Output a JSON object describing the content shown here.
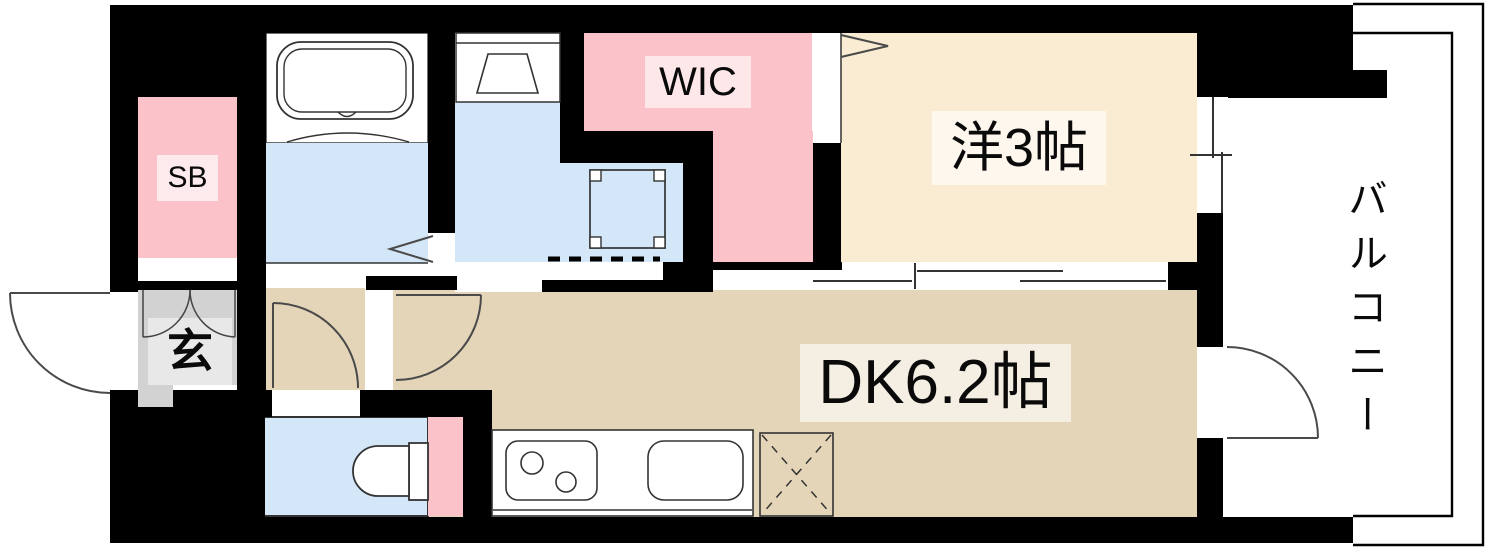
{
  "floorplan": {
    "title": "apartment-floor-plan",
    "rooms": {
      "sb": {
        "label": "SB"
      },
      "entrance": {
        "label": "玄"
      },
      "wic": {
        "label": "WIC"
      },
      "western": {
        "label": "洋3帖"
      },
      "dk": {
        "label": "DK6.2帖"
      },
      "balcony": {
        "label": "バルコニー"
      }
    },
    "colors": {
      "wall": "#000000",
      "dk_floor": "#e4d5b8",
      "western_floor": "#faecd2",
      "closet_pink": "#fbc3c9",
      "water_blue": "#d4e7f8",
      "genkan_gray": "#d2d2d2",
      "genkan_inner": "#e8e8e8",
      "fixture_fill": "#ffffff",
      "line": "#333333"
    }
  }
}
